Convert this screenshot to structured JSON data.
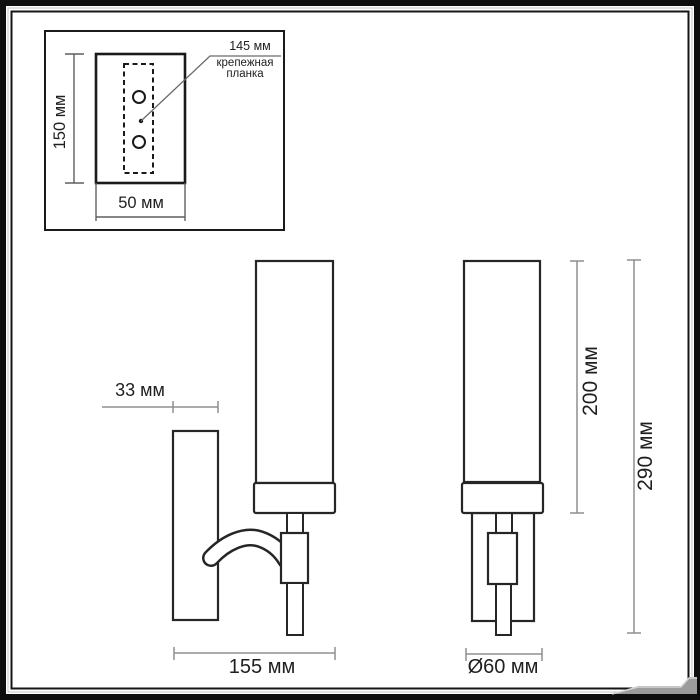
{
  "colors": {
    "outline": "#262626",
    "inset_outline": "#1a1a1a",
    "dimension_line": "#8f8f8f",
    "inset_dimension_line": "#5f5f5f",
    "text": "#1f1f1f",
    "frame": "#0e0e0e",
    "corner_artifact": "#9c9c9c",
    "background": "#ffffff"
  },
  "inset": {
    "height_dim": "150 мм",
    "width_dim": "50 мм",
    "callout_value": "145 мм",
    "callout_label_line1": "крепежная",
    "callout_label_line2": "планка"
  },
  "main": {
    "wall_offset_dim": "33 мм",
    "depth_dim": "155 мм",
    "shade_height_dim": "200 мм",
    "overall_height_dim": "290 мм",
    "diameter_dim": "Ø60 мм"
  }
}
